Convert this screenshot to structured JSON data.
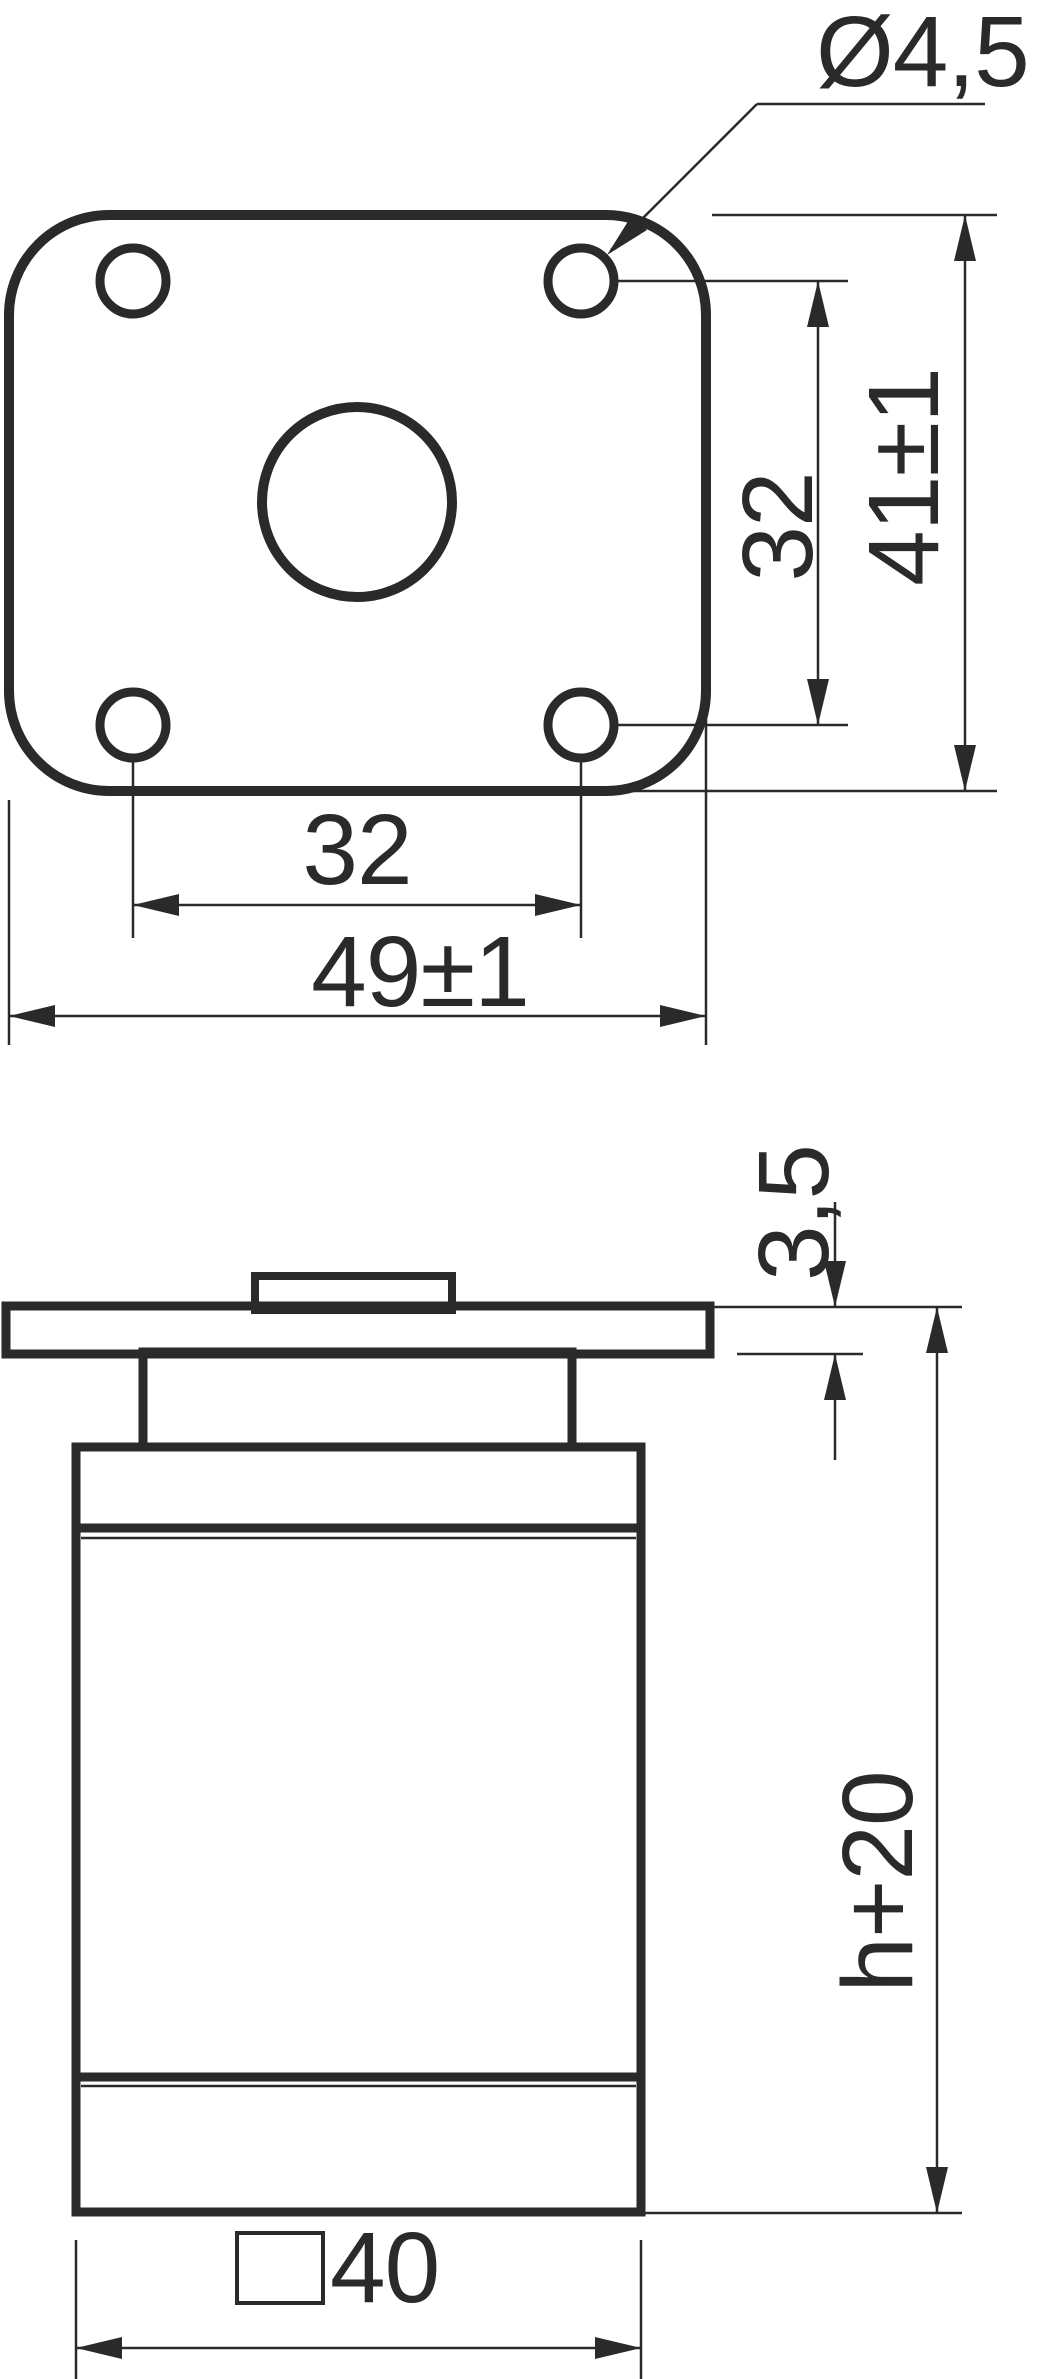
{
  "drawing": {
    "kind": "furniture-leg-technical-drawing",
    "top_view": {
      "hole_diameter": "Ø4,5",
      "hole_spacing_vertical": "32",
      "plate_height": "41±1",
      "hole_spacing_horizontal": "32",
      "plate_width": "49±1"
    },
    "side_view": {
      "plate_thickness": "3,5",
      "leg_height": "h+20",
      "tube_size": "40",
      "tube_size_symbol": "square-section"
    },
    "colors": {
      "line": "#2b2a29",
      "background": "#ffffff"
    }
  }
}
